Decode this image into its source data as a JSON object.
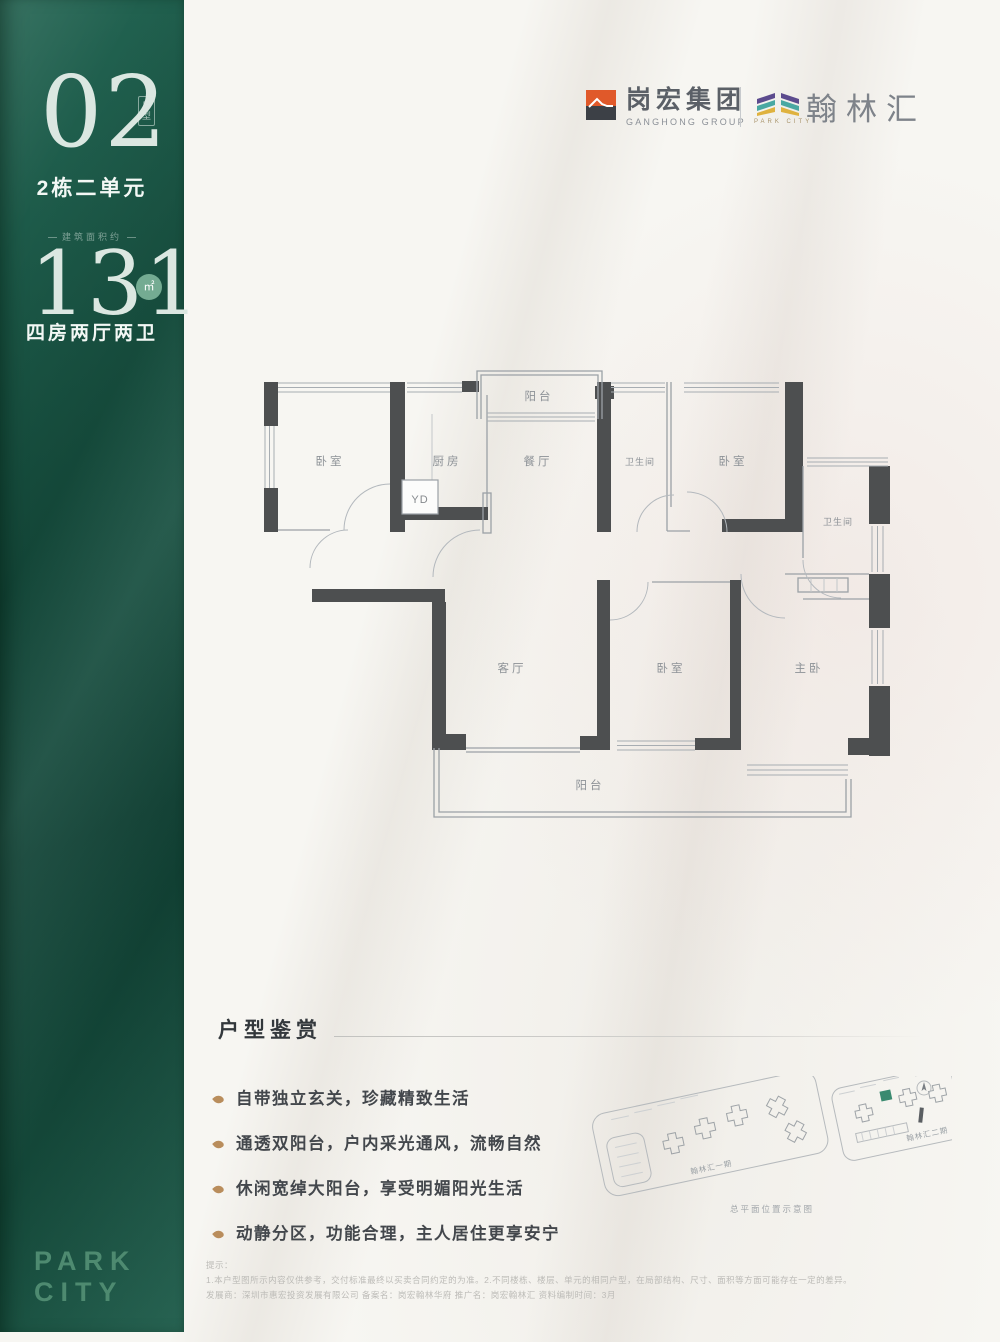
{
  "sidebar": {
    "unit_number": "02",
    "unit_type_badge": "户型",
    "building_unit": "2栋二单元",
    "area_caption": "建筑面积约",
    "area_value": "131",
    "area_unit": "㎡",
    "layout_summary": "四房两厅两卫",
    "wordmark_line1": "PARK",
    "wordmark_line2": "CITY"
  },
  "header": {
    "developer": {
      "name": "岗宏集团",
      "subtitle": "GANGHONG GROUP"
    },
    "project": {
      "name": "翰林汇",
      "subtitle": "PARK CITY"
    }
  },
  "floorplan": {
    "rooms": {
      "balcony_top": "阳台",
      "bedroom_top_left": "卧室",
      "kitchen": "厨房",
      "laundry": "YD",
      "dining": "餐厅",
      "bathroom_1": "卫生间",
      "bedroom_top_right": "卧室",
      "bathroom_2": "卫生间",
      "living": "客厅",
      "bedroom_bottom": "卧室",
      "master_bedroom": "主卧",
      "balcony_bottom": "阳台"
    }
  },
  "features": {
    "title": "户型鉴赏",
    "items": [
      "自带独立玄关，珍藏精致生活",
      "通透双阳台，户内采光通风，流畅自然",
      "休闲宽绰大阳台，享受明媚阳光生活",
      "动静分区，功能合理，主人居住更享安宁"
    ]
  },
  "siteplan": {
    "phase1_label": "翰林汇一期",
    "phase2_label": "翰林汇二期",
    "caption": "总平面位置示意图"
  },
  "disclaimer": {
    "heading": "提示：",
    "line1": "1.本户型图所示内容仅供参考，交付标准最终以买卖合同约定的为准。2.不同楼栋、楼层、单元的相同户型，在局部结构、尺寸、面积等方面可能存在一定的差异。",
    "line2": "发展商：深圳市惠宏投资发展有限公司 备案名：岗宏翰林华府 推广名：岗宏翰林汇 资料编制时间：3月"
  },
  "colors": {
    "sidebar_green": "#1a5847",
    "accent_teal": "#74ab92",
    "logo_orange": "#e0592a",
    "logo_purple": "#5c4b8e",
    "logo_teal": "#49a8a2",
    "logo_gold": "#dfb23f",
    "wall_dark": "#4d4f50",
    "highlight_building": "#3a8a70"
  }
}
